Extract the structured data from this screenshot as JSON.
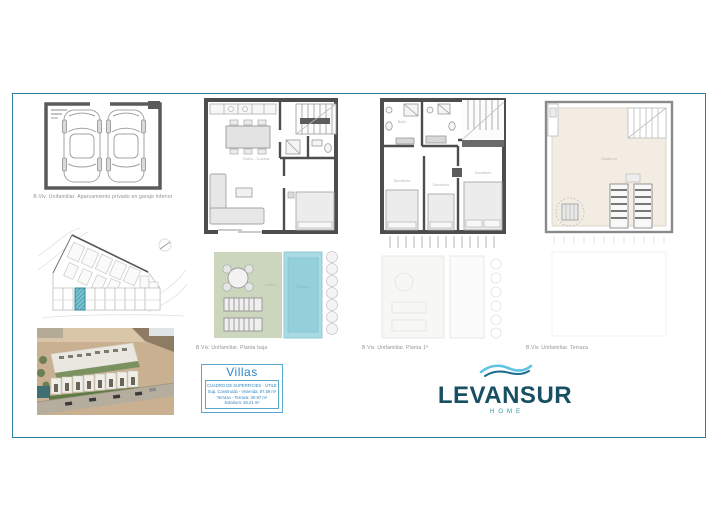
{
  "sheet": {
    "type": "architectural-plan-sheet",
    "frame_color": "#2e7fa0",
    "background": "#ffffff"
  },
  "plans": {
    "garage": {
      "caption": "B.Viv. Unifamiliar. Aparcamiento privado en garaje inferior"
    },
    "ground": {
      "caption": "B.Viv. Unifamiliar. Planta baja",
      "label_living": "Salón - Cocina",
      "label_garden": "Jardín",
      "label_pool": "Piscina"
    },
    "first": {
      "caption": "B.Viv. Unifamiliar. Planta 1ª",
      "label_bed1": "Dormitorio",
      "label_bed2": "Dormitorio",
      "label_bed3": "Dormitorio",
      "label_bath": "Baño"
    },
    "roof": {
      "caption": "B.Viv. Unifamiliar. Terraza",
      "label_solarium": "Solarium"
    }
  },
  "villas_box": {
    "title": "Villas",
    "line1": "CUADRO DE SUPERFICIES - ÚTILES",
    "line2": "Sup. Construida - Vivienda: 97.59 m²",
    "line3": "Terraza - Terraza: 30.97 m²",
    "line4": "Solarium: 36.21 m²",
    "accent": "#2f86c3"
  },
  "logo": {
    "name": "LEVANSUR",
    "tagline": "HOME",
    "color_primary": "#184f63",
    "color_accent": "#2a93a8",
    "wave_light": "#5fc4e4",
    "wave_dark": "#1a6d8f"
  },
  "colors": {
    "walls": "#4d4d4d",
    "pool": "#a9dae3",
    "pool_inner": "#95cfda",
    "garden": "#ccd6bd",
    "solarium": "#f3ece2",
    "site_highlight": "#4ba3b8"
  }
}
